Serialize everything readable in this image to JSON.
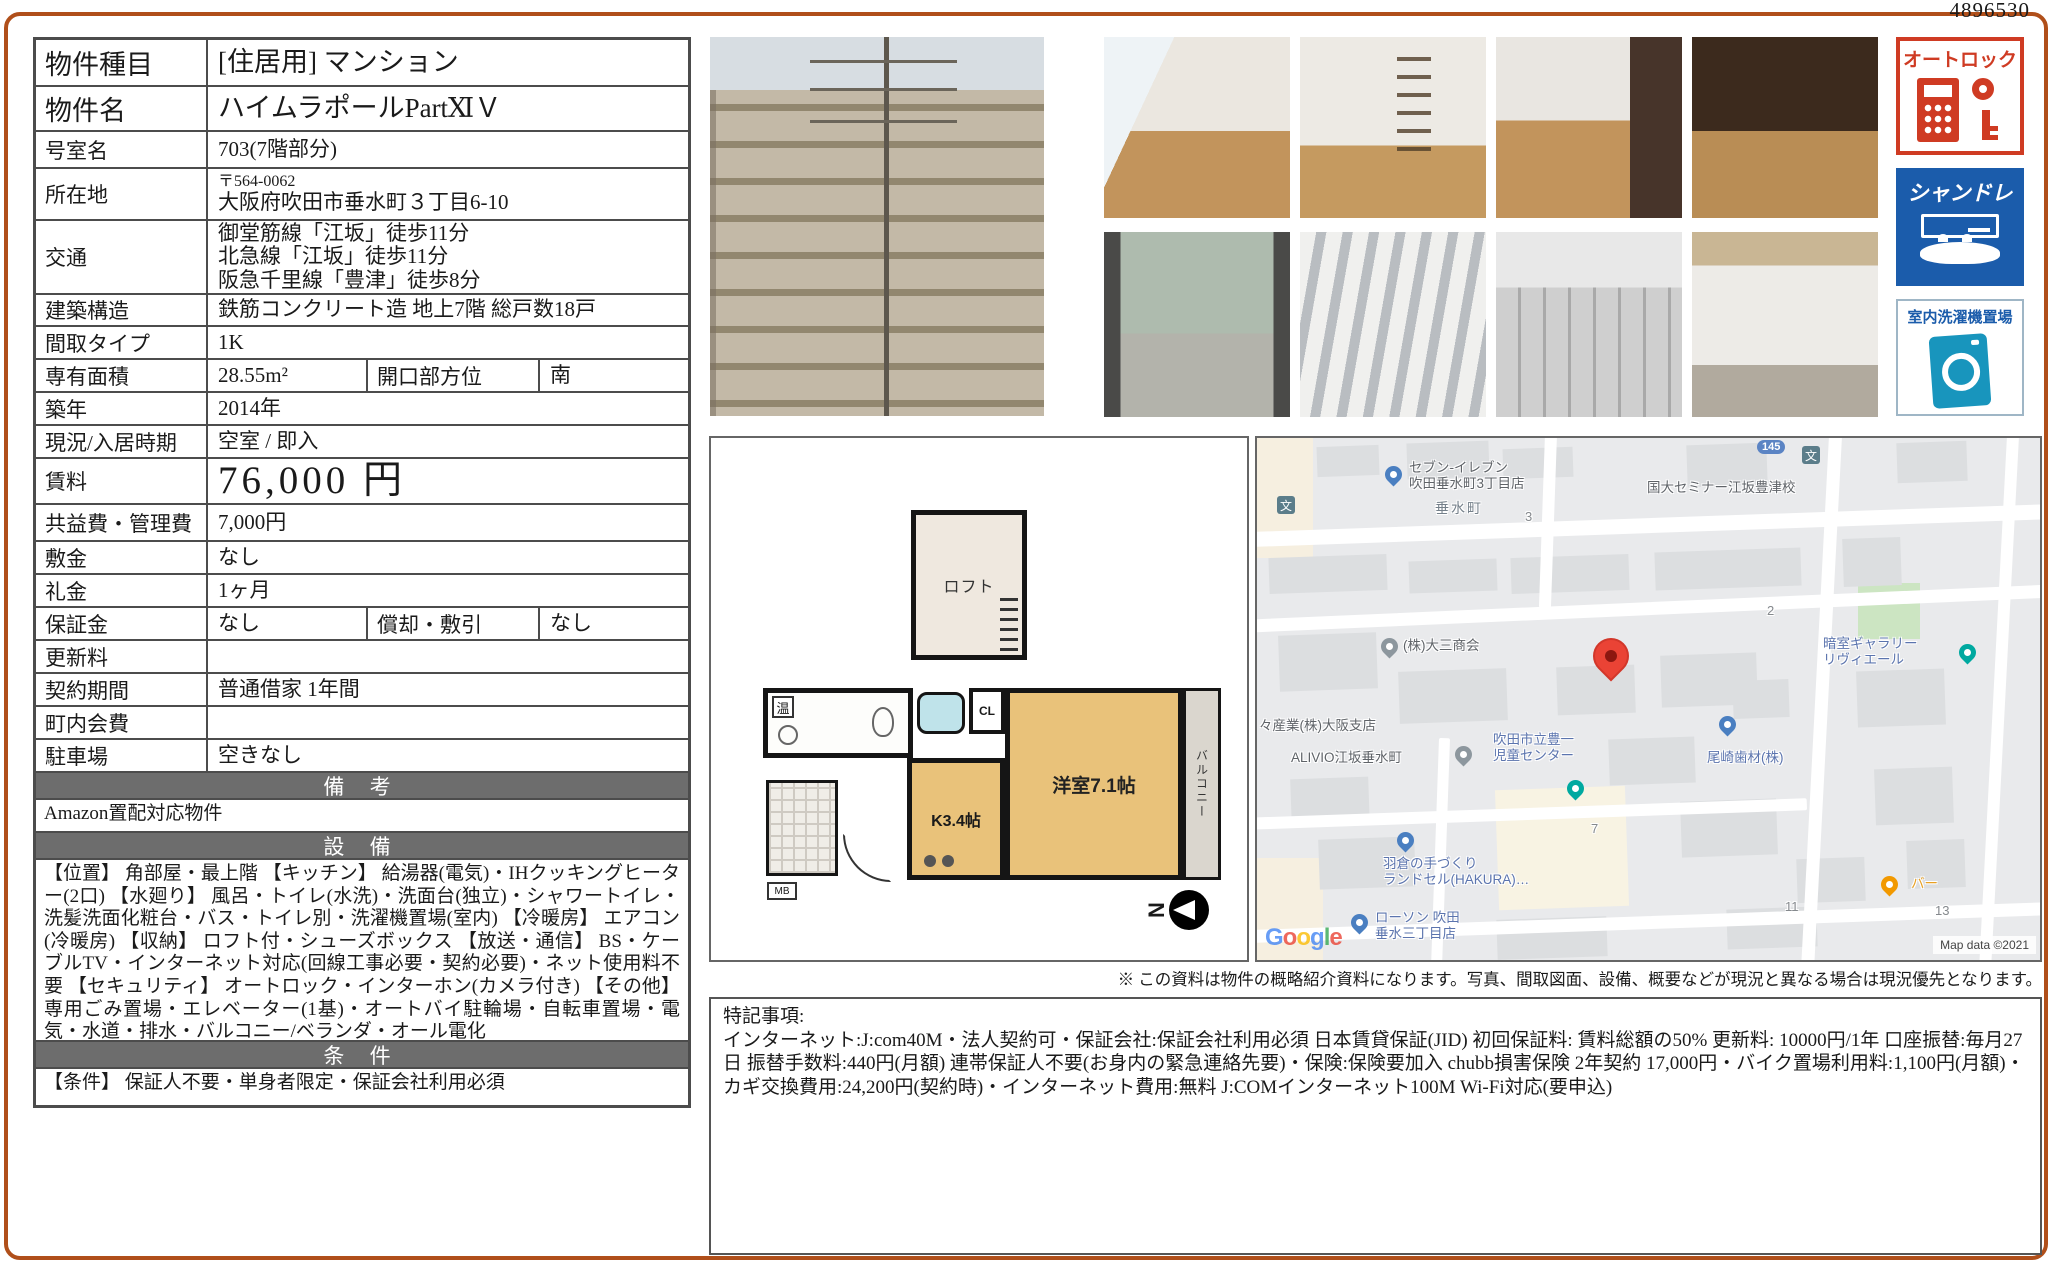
{
  "doc_number": "4896530",
  "property_table": {
    "rows": [
      {
        "label": "物件種目",
        "value": "[住居用] マンション",
        "big": true
      },
      {
        "label": "物件名",
        "value": "ハイムラポールPartⅪＶ",
        "big": true
      },
      {
        "label": "号室名",
        "value": "703(7階部分)"
      },
      {
        "label": "所在地",
        "value": "〒564-0062\n大阪府吹田市垂水町３丁目6-10",
        "addr": true
      },
      {
        "label": "交通",
        "value": "御堂筋線「江坂」徒歩11分\n北急線「江坂」徒歩11分\n阪急千里線「豊津」徒歩8分"
      },
      {
        "label": "建築構造",
        "value": "鉄筋コンクリート造 地上7階 総戸数18戸"
      },
      {
        "label": "間取タイプ",
        "value": "1K"
      },
      {
        "label": "専有面積",
        "value": "28.55m²",
        "label2": "開口部方位",
        "value2": "南",
        "split": true
      },
      {
        "label": "築年",
        "value": "2014年"
      },
      {
        "label": "現況/入居時期",
        "value": "空室 / 即入"
      },
      {
        "label": "賃料",
        "value": "76,000 円",
        "rent": true
      },
      {
        "label": "共益費・管理費",
        "value": "7,000円"
      },
      {
        "label": "敷金",
        "value": "なし"
      },
      {
        "label": "礼金",
        "value": "1ヶ月"
      },
      {
        "label": "保証金",
        "value": "なし",
        "label2": "償却・敷引",
        "value2": "なし",
        "split": true
      },
      {
        "label": "更新料",
        "value": ""
      },
      {
        "label": "契約期間",
        "value": "普通借家 1年間"
      },
      {
        "label": "町内会費",
        "value": ""
      },
      {
        "label": "駐車場",
        "value": "空きなし"
      }
    ],
    "sections": [
      {
        "header": "備 考",
        "body": "Amazon置配対応物件"
      },
      {
        "header": "設 備",
        "body": "【位置】 角部屋・最上階 【キッチン】 給湯器(電気)・IHクッキングヒーター(2口) 【水廻り】 風呂・トイレ(水洗)・洗面台(独立)・シャワートイレ・洗髪洗面化粧台・バス・トイレ別・洗濯機置場(室内) 【冷暖房】 エアコン(冷暖房) 【収納】 ロフト付・シューズボックス 【放送・通信】 BS・ケーブルTV・インターネット対応(回線工事必要・契約必要)・ネット使用料不要 【セキュリティ】 オートロック・インターホン(カメラ付き) 【その他】 専用ごみ置場・エレベーター(1基)・オートバイ駐輪場・自転車置場・電気・水道・排水・バルコニー/ベランダ・オール電化"
      },
      {
        "header": "条 件",
        "body": "【条件】 保証人不要・単身者限定・保証会社利用必須"
      }
    ]
  },
  "photos": {
    "building": "exterior-building-photo",
    "grid": [
      {
        "cls": "ph1",
        "name": "interior-room-window"
      },
      {
        "cls": "ph2",
        "name": "interior-loft-ladder"
      },
      {
        "cls": "ph3",
        "name": "interior-room-counter"
      },
      {
        "cls": "ph4",
        "name": "interior-kitchen"
      },
      {
        "cls": "ph5",
        "name": "balcony-view"
      },
      {
        "cls": "ph6",
        "name": "building-corridor"
      },
      {
        "cls": "ph7",
        "name": "entrance-mailboxes"
      },
      {
        "cls": "ph8",
        "name": "common-corridor"
      }
    ]
  },
  "badges": [
    {
      "label": "オートロック"
    },
    {
      "label": "シャンドレ"
    },
    {
      "label": "室内洗濯機置場"
    }
  ],
  "floorplan": {
    "loft": "ロフト",
    "western": "洋室7.1帖",
    "kitchen": "K3.4帖",
    "closet": "CL",
    "balcony": "バルコニー",
    "bath": "温",
    "mb": "MB"
  },
  "map": {
    "pois": [
      {
        "text": "セブン-イレブン\n吹田垂水町3丁目店",
        "x": 152,
        "y": 22,
        "cls": "poi-dark",
        "pin": {
          "cls": "pin-store",
          "x": 128,
          "y": 28
        }
      },
      {
        "text": "垂水町",
        "x": 178,
        "y": 62,
        "cls": "poi-area"
      },
      {
        "text": "3",
        "x": 268,
        "y": 72,
        "cls": "poi-num"
      },
      {
        "text": "国大セミナー江坂豊津校",
        "x": 390,
        "y": 42,
        "cls": "poi-dark"
      },
      {
        "text": "145",
        "x": 500,
        "y": 2,
        "cls": "route-badge"
      },
      {
        "text": "文",
        "x": 545,
        "y": 8,
        "cls": "pin-school"
      },
      {
        "text": "文",
        "x": 20,
        "y": 58,
        "cls": "pin-school"
      },
      {
        "text": "2",
        "x": 510,
        "y": 166,
        "cls": "poi-num"
      },
      {
        "text": "(株)大三商会",
        "x": 146,
        "y": 200,
        "cls": "poi-dark",
        "pin": {
          "cls": "pin-gray",
          "x": 124,
          "y": 200
        }
      },
      {
        "text": "暗室ギャラリー\nリヴィエール",
        "x": 566,
        "y": 198,
        "cls": "poi-blue",
        "pin": {
          "cls": "pin-teal",
          "x": 702,
          "y": 206
        }
      },
      {
        "text": "々産業(株)大阪支店",
        "x": 2,
        "y": 280,
        "cls": "poi-dark"
      },
      {
        "text": "ALIVIO江坂垂水町",
        "x": 34,
        "y": 312,
        "cls": "poi-dark",
        "pin": {
          "cls": "pin-gray",
          "x": 198,
          "y": 308
        }
      },
      {
        "text": "吹田市立豊一\n児童センター",
        "x": 236,
        "y": 294,
        "cls": "poi-blue",
        "pin": {
          "cls": "pin-teal",
          "x": 310,
          "y": 342
        }
      },
      {
        "text": "尾崎歯材(株)",
        "x": 450,
        "y": 312,
        "cls": "poi-blue",
        "pin": {
          "cls": "pin-store",
          "x": 462,
          "y": 278
        }
      },
      {
        "text": "7",
        "x": 334,
        "y": 384,
        "cls": "poi-num"
      },
      {
        "text": "羽倉の手づくり\nランドセル(HAKURA)…",
        "x": 126,
        "y": 418,
        "cls": "poi-blue",
        "pin": {
          "cls": "pin-store",
          "x": 140,
          "y": 394
        }
      },
      {
        "text": "バー",
        "x": 654,
        "y": 438,
        "cls": "poi-orange",
        "pin": {
          "cls": "pin-bar",
          "x": 624,
          "y": 438
        }
      },
      {
        "text": "11",
        "x": 528,
        "y": 462,
        "cls": "poi-num"
      },
      {
        "text": "13",
        "x": 678,
        "y": 466,
        "cls": "poi-num"
      },
      {
        "text": "ローソン 吹田\n垂水三丁目店",
        "x": 118,
        "y": 472,
        "cls": "poi-blue",
        "pin": {
          "cls": "pin-store",
          "x": 94,
          "y": 476
        }
      }
    ],
    "marker": {
      "x": 336,
      "y": 200
    },
    "google": "Google",
    "copyright": "Map data ©2021"
  },
  "map_note": "※ この資料は物件の概略紹介資料になります。写真、間取図面、設備、概要などが現況と異なる場合は現況優先となります。",
  "remarks": {
    "title": "特記事項:",
    "body": "インターネット:J:com40M・法人契約可・保証会社:保証会社利用必須 日本賃貸保証(JID) 初回保証料: 賃料総額の50% 更新料: 10000円/1年 口座振替:毎月27日 振替手数料:440円(月額) 連帯保証人不要(お身内の緊急連絡先要)・保険:保険要加入 chubb損害保険 2年契約 17,000円・バイク置場利用料:1,100円(月額)・カギ交換費用:24,200円(契約時)・インターネット費用:無料 J:COMインターネット100M Wi-Fi対応(要申込)"
  }
}
